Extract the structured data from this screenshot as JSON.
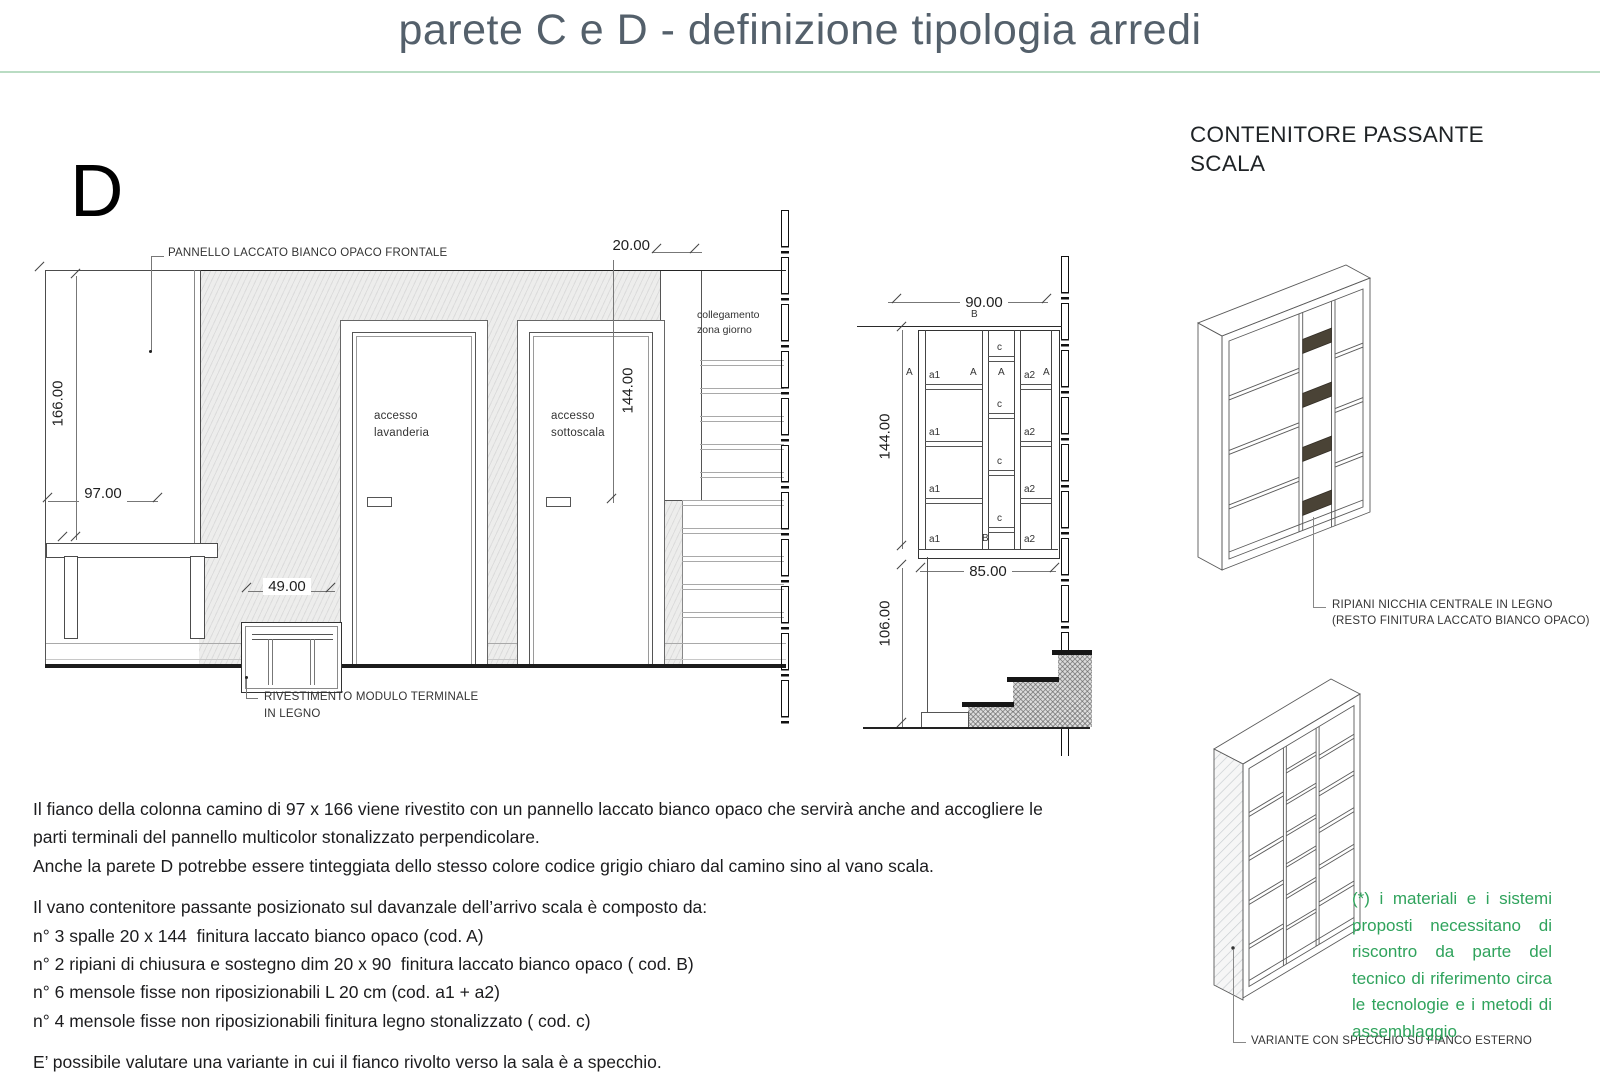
{
  "title": "parete C e D - definizione tipologia arredi",
  "section_label": "D",
  "colors": {
    "accent_green_rule": "#b9dcc3",
    "note_green": "#2fa35c",
    "title_gray": "#54606b",
    "wood_shelf_dark": "#4a4336"
  },
  "elevation": {
    "panel_label": "PANNELLO LACCATO BIANCO OPACO FRONTALE",
    "module_label_1": "RIVESTIMENTO MODULO TERMINALE",
    "module_label_2": "IN LEGNO",
    "door1_line1": "accesso",
    "door1_line2": "lavanderia",
    "door2_line1": "accesso",
    "door2_line2": "sottoscala",
    "stair_label_1": "collegamento",
    "stair_label_2": "zona giorno",
    "dims": {
      "panel_height": "166.00",
      "panel_width": "97.00",
      "module_width": "49.00",
      "shelf_depth": "20.00",
      "door_height": "144.00"
    }
  },
  "shelf_front": {
    "dims": {
      "width": "90.00",
      "height": "144.00",
      "inner_width": "85.00",
      "parapet_height": "106.00"
    },
    "codes": {
      "a1": "a1",
      "a2": "a2",
      "c": "c",
      "A": "A",
      "B": "B"
    }
  },
  "right_panel": {
    "heading_line1": "CONTENITORE PASSANTE",
    "heading_line2": "SCALA",
    "iso1_label_1": "RIPIANI NICCHIA CENTRALE IN LEGNO",
    "iso1_label_2": "(RESTO FINITURA LACCATO BIANCO OPACO)",
    "iso2_label": "VARIANTE CON SPECCHIO SU FIANCO ESTERNO",
    "note": "(*) i materiali e i sistemi proposti necessitano di riscontro da parte del tecnico di riferimento circa le tecnologie e i metodi di assemblaggio"
  },
  "body": {
    "lines": [
      "Il fianco della colonna camino di 97 x 166 viene rivestito con un pannello laccato bianco opaco che servirà anche and accogliere le",
      "parti terminali del pannello multicolor stonalizzato perpendicolare.",
      "Anche la parete D potrebbe essere tinteggiata dello stesso colore codice grigio chiaro dal camino sino al vano scala.",
      "Il vano contenitore passante posizionato sul davanzale dell’arrivo scala è composto da:",
      "n° 3 spalle 20 x 144  finitura laccato bianco opaco (cod. A)",
      "n° 2 ripiani di chiusura e sostegno dim 20 x 90  finitura laccato bianco opaco ( cod. B)",
      "n° 6 mensole fisse non riposizionabili L 20 cm (cod. a1 + a2)",
      "n° 4 mensole fisse non riposizionabili finitura legno stonalizzato ( cod. c)",
      "E’ possibile valutare una variante in cui il fianco rivolto verso la sala è a specchio."
    ]
  }
}
